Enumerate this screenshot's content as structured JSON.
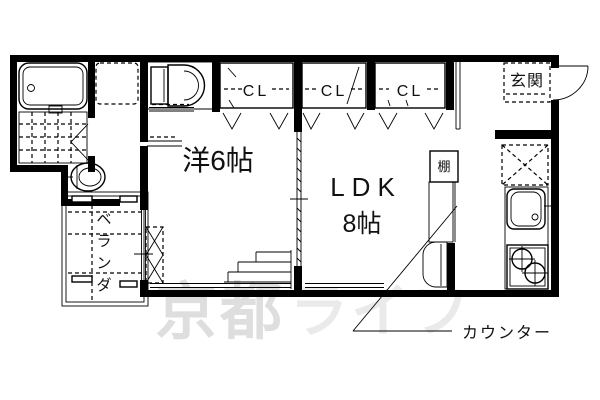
{
  "plan": {
    "labels": {
      "western_room": "洋6帖",
      "ldk_name": "LDK",
      "ldk_size": "8帖",
      "entrance": "玄関",
      "shelf": "棚",
      "counter": "カウンター",
      "closet_1": "CL",
      "closet_2": "CL",
      "closet_3": "CL",
      "veranda_chars": [
        "ベ",
        "ラ",
        "ン",
        "ダ"
      ]
    },
    "watermark": {
      "part1": "京都",
      "part2": "ライフ"
    },
    "colors": {
      "line": "#000000",
      "label": "#111111",
      "watermark_dark": "#dedede",
      "watermark_light": "#eaeaea",
      "background": "#ffffff"
    }
  }
}
